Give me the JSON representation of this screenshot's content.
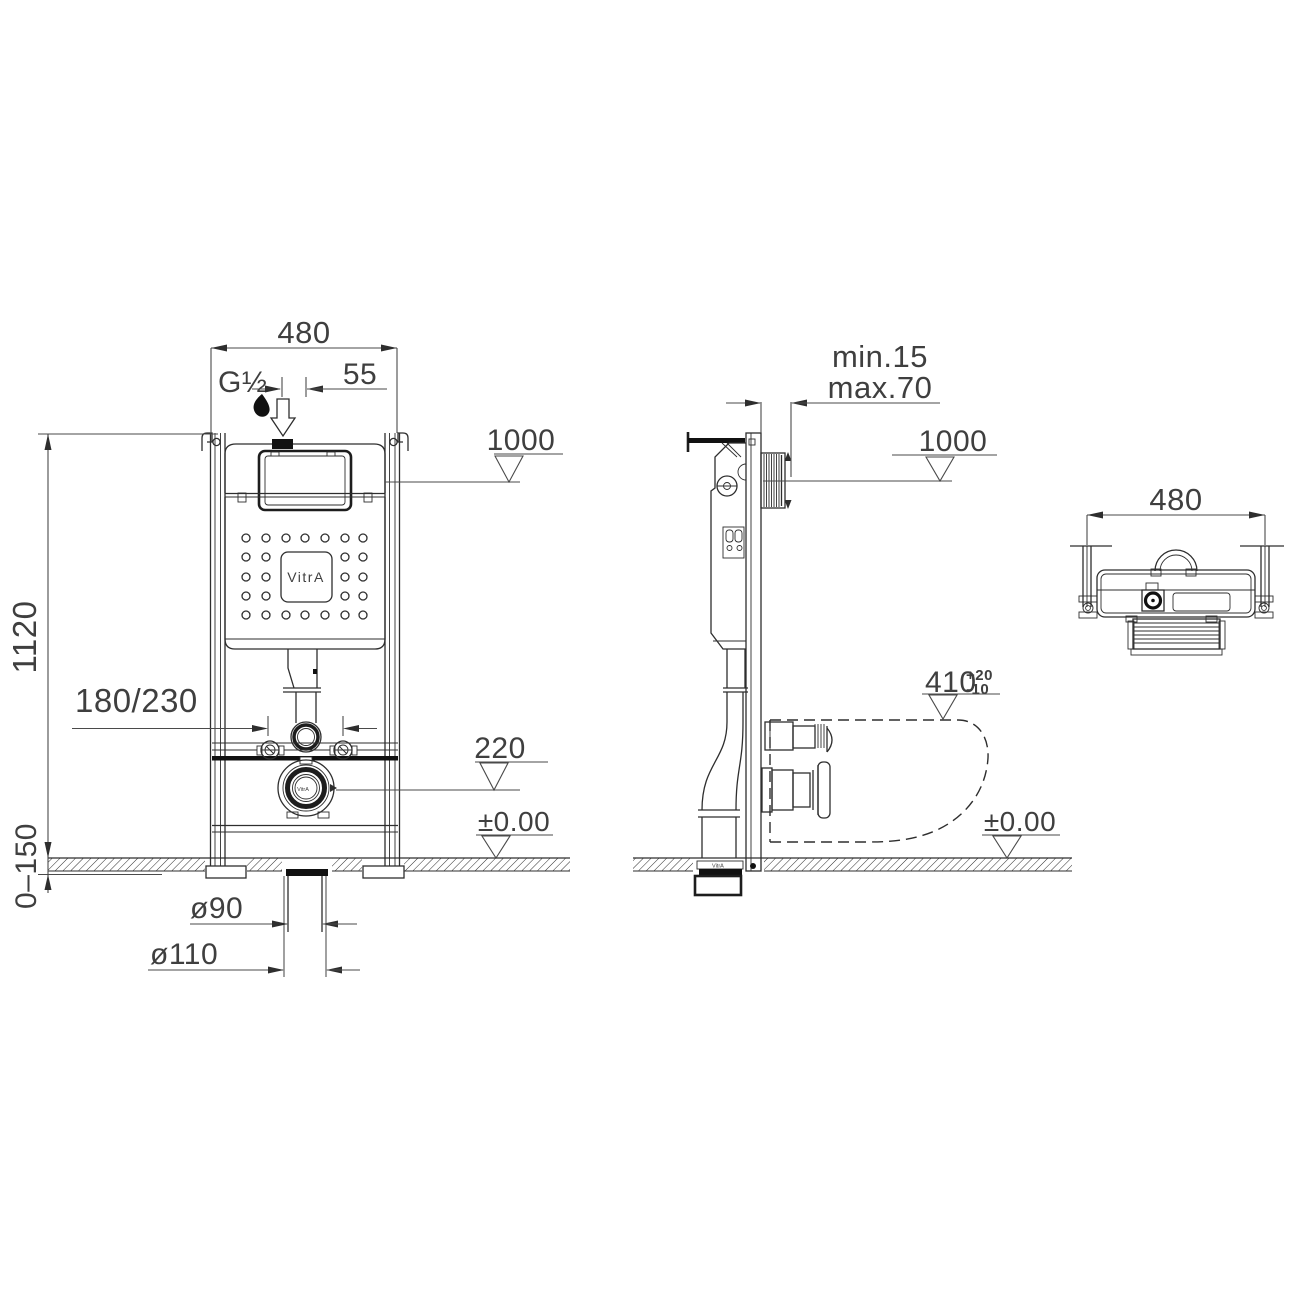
{
  "meta": {
    "brand": "VitrA",
    "drawing_type": "concealed-cistern-frame-installation-dimensions"
  },
  "labels": {
    "front": {
      "width": "480",
      "inlet_thread": "G½",
      "inlet_offset": "55",
      "level_flush_plate": "1000",
      "frame_height": "1120",
      "fixing_width": "180/230",
      "outlet_center_height": "220",
      "floor_level": "±0.00",
      "foot_adjust_range": "0–150",
      "waste_d90": "ø90",
      "waste_d110": "ø110",
      "logo": "VitrA",
      "flange_brand": "VitrA"
    },
    "side": {
      "finish_min": "min.15",
      "finish_max": "max.70",
      "level_flush_plate": "1000",
      "bowl_top_height": "410",
      "bowl_tol_plus": "+20",
      "bowl_tol_minus": "-10",
      "floor_level": "±0.00",
      "pipe_brand": "VitrA"
    },
    "top": {
      "width": "480"
    }
  }
}
